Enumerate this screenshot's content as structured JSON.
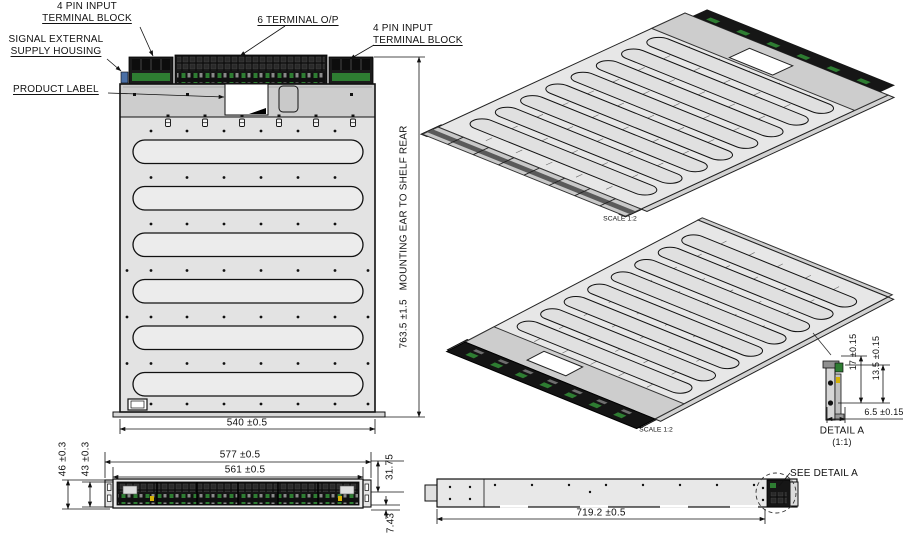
{
  "sheet": {
    "callouts": {
      "pin4_left_line1": "4 PIN INPUT",
      "pin4_left_line2": "TERMINAL BLOCK",
      "terminal6": "6 TERMINAL O/P",
      "pin4_right_line1": "4 PIN INPUT",
      "pin4_right_line2": "TERMINAL BLOCK",
      "signal_line1": "SIGNAL EXTERNAL",
      "signal_line2": "SUPPLY HOUSING",
      "product_label": "PRODUCT LABEL",
      "see_detail": "SEE DETAIL A"
    },
    "plan_view": {
      "width_dim": "540 ±0.5",
      "depth_dim": "763.5 ±1.5   MOUNTING EAR TO SHELF REAR"
    },
    "iso_top": {
      "scale": "SCALE 1:2"
    },
    "iso_bottom": {
      "scale": "SCALE 1:2"
    },
    "front_view": {
      "outer_width": "577 ±0.5",
      "inner_width": "561 ±0.5",
      "outer_height": "46 ±0.3",
      "inner_height": "43 ±0.3",
      "right_upper": "31.75",
      "right_lower": "7.43"
    },
    "side_view": {
      "length_dim": "719.2 ±0.5"
    },
    "detail_a": {
      "title": "DETAIL A",
      "scale": "(1:1)",
      "height_outer": "17 ±0.15",
      "height_inner": "13.5 ±0.15",
      "width": "6.5 ±0.15"
    },
    "colors": {
      "line": "#1a1a1a",
      "body_fill": "#e3e3e3",
      "flange_fill": "#cdcdcd",
      "terminal_block": "#161616",
      "accent_green": "#2e7d32",
      "accent_orange": "#c87820",
      "accent_blue": "#4a6fa5"
    }
  }
}
